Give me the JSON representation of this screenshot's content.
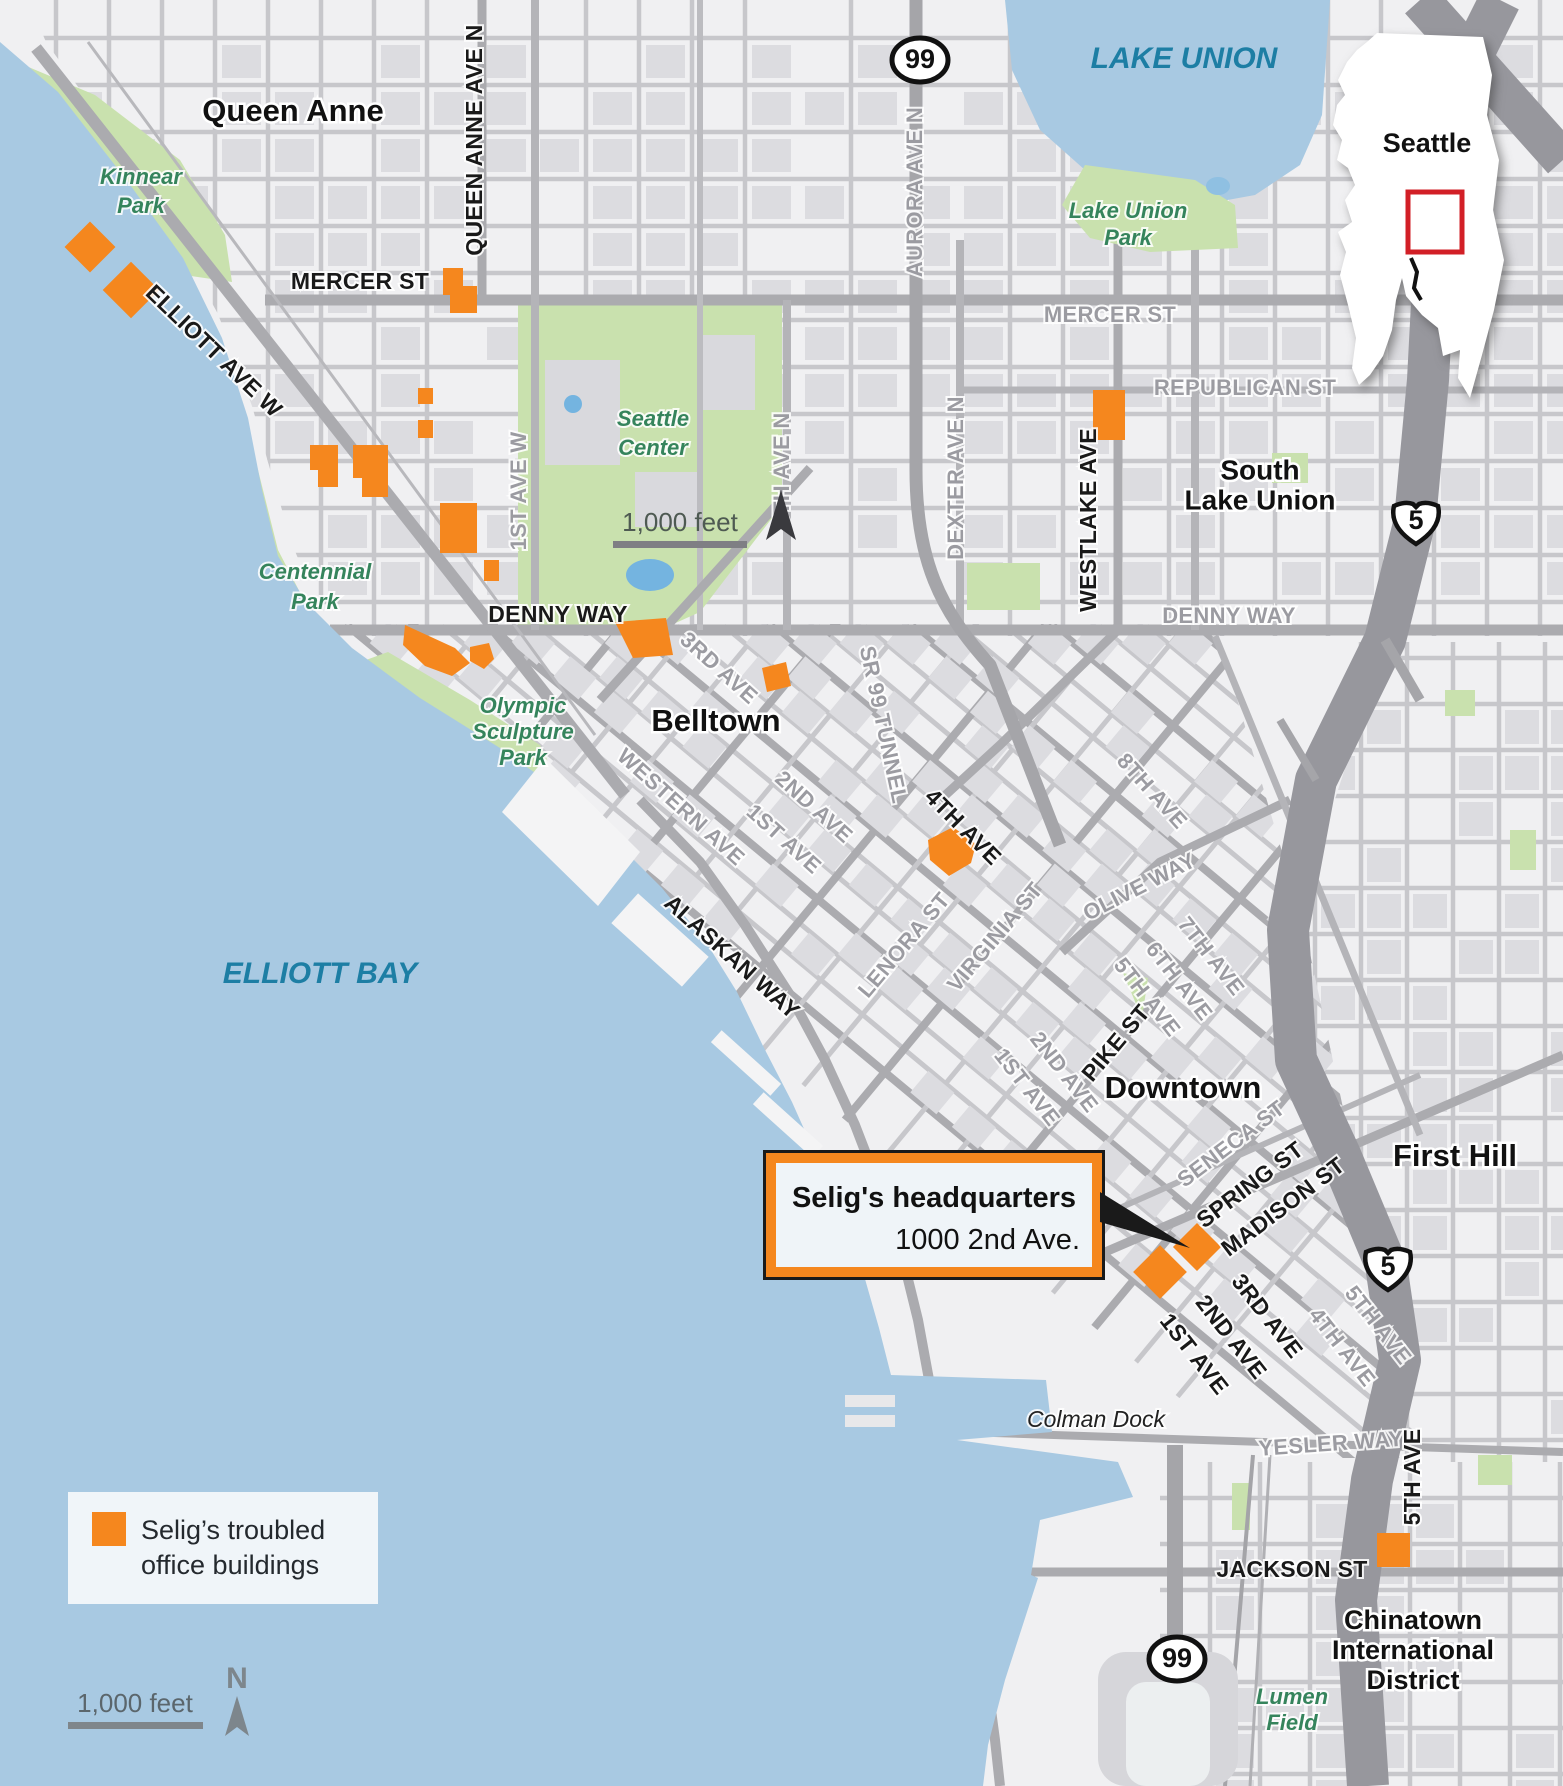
{
  "colors": {
    "marker": "#f5871e",
    "water": "#a8c9e2",
    "park": "#c9e1ae",
    "land": "#f0f0f2",
    "block": "#dcdce0",
    "street": "#c7c7cb",
    "major_road": "#ababaf",
    "freeway": "#97979d",
    "inset_rect": "#d21f26",
    "water_label": "#1d7ea4",
    "park_label": "#35845c"
  },
  "legend": {
    "line1": "Selig’s troubled",
    "line2": "office buildings"
  },
  "callout": {
    "title": "Selig's headquarters",
    "subtitle": "1000 2nd Ave."
  },
  "inset": {
    "city": "Seattle"
  },
  "scale_top": {
    "label": "1,000 feet"
  },
  "scale_bottom": {
    "label": "1,000 feet",
    "north": "N"
  },
  "map": {
    "labels": [
      {
        "id": "queen-anne",
        "t": "Queen Anne",
        "x": 293,
        "y": 113,
        "r": 0,
        "c": "nb"
      },
      {
        "id": "belltown",
        "t": "Belltown",
        "x": 716,
        "y": 723,
        "r": 0,
        "c": "nb"
      },
      {
        "id": "downtown",
        "t": "Downtown",
        "x": 1183,
        "y": 1090,
        "r": 0,
        "c": "nb"
      },
      {
        "id": "first-hill",
        "t": "First Hill",
        "x": 1455,
        "y": 1158,
        "r": 0,
        "c": "nb"
      },
      {
        "id": "slu-1",
        "t": "South",
        "x": 1260,
        "y": 472,
        "r": 0,
        "c": "nb2"
      },
      {
        "id": "slu-2",
        "t": "Lake Union",
        "x": 1260,
        "y": 502,
        "r": 0,
        "c": "nb2"
      },
      {
        "id": "cid-1",
        "t": "Chinatown",
        "x": 1413,
        "y": 1622,
        "r": 0,
        "c": "nb3"
      },
      {
        "id": "cid-2",
        "t": "International",
        "x": 1413,
        "y": 1652,
        "r": 0,
        "c": "nb3"
      },
      {
        "id": "cid-3",
        "t": "District",
        "x": 1413,
        "y": 1682,
        "r": 0,
        "c": "nb3"
      },
      {
        "id": "lake-union",
        "t": "LAKE UNION",
        "x": 1184,
        "y": 60,
        "r": 0,
        "c": "wa"
      },
      {
        "id": "elliott-bay",
        "t": "ELLIOTT BAY",
        "x": 320,
        "y": 975,
        "r": 0,
        "c": "wa"
      },
      {
        "id": "kinnear-1",
        "t": "Kinnear",
        "x": 141,
        "y": 178,
        "r": 0,
        "c": "pk"
      },
      {
        "id": "kinnear-2",
        "t": "Park",
        "x": 141,
        "y": 207,
        "r": 0,
        "c": "pk"
      },
      {
        "id": "lup-1",
        "t": "Lake Union",
        "x": 1128,
        "y": 212,
        "r": 0,
        "c": "pk"
      },
      {
        "id": "lup-2",
        "t": "Park",
        "x": 1128,
        "y": 239,
        "r": 0,
        "c": "pk"
      },
      {
        "id": "sc-1",
        "t": "Seattle",
        "x": 653,
        "y": 420,
        "r": 0,
        "c": "pk"
      },
      {
        "id": "sc-2",
        "t": "Center",
        "x": 653,
        "y": 449,
        "r": 0,
        "c": "pk"
      },
      {
        "id": "cen-1",
        "t": "Centennial",
        "x": 315,
        "y": 573,
        "r": 0,
        "c": "pk"
      },
      {
        "id": "cen-2",
        "t": "Park",
        "x": 315,
        "y": 603,
        "r": 0,
        "c": "pk"
      },
      {
        "id": "osp-1",
        "t": "Olympic",
        "x": 523,
        "y": 707,
        "r": 0,
        "c": "pk"
      },
      {
        "id": "osp-2",
        "t": "Sculpture",
        "x": 523,
        "y": 733,
        "r": 0,
        "c": "pk"
      },
      {
        "id": "osp-3",
        "t": "Park",
        "x": 523,
        "y": 759,
        "r": 0,
        "c": "pk"
      },
      {
        "id": "lumen-1",
        "t": "Lumen",
        "x": 1292,
        "y": 1698,
        "r": 0,
        "c": "pk"
      },
      {
        "id": "lumen-2",
        "t": "Field",
        "x": 1292,
        "y": 1724,
        "r": 0,
        "c": "pk"
      },
      {
        "id": "colman-dock",
        "t": "Colman Dock",
        "x": 1096,
        "y": 1421,
        "r": 0,
        "c": "pl"
      },
      {
        "id": "mercer-w",
        "t": "MERCER ST",
        "x": 360,
        "y": 283,
        "r": 0,
        "c": "sd"
      },
      {
        "id": "mercer-e",
        "t": "MERCER ST",
        "x": 1110,
        "y": 316,
        "r": 0,
        "c": "sg"
      },
      {
        "id": "republican",
        "t": "REPUBLICAN ST",
        "x": 1245,
        "y": 389,
        "r": 0,
        "c": "sg"
      },
      {
        "id": "denny-w",
        "t": "DENNY WAY",
        "x": 558,
        "y": 616,
        "r": 0,
        "c": "sd"
      },
      {
        "id": "denny-e",
        "t": "DENNY WAY",
        "x": 1229,
        "y": 617,
        "r": 0,
        "c": "sg"
      },
      {
        "id": "queen-anne-ave",
        "t": "QUEEN ANNE AVE N",
        "x": 476,
        "y": 140,
        "r": -90,
        "c": "sd"
      },
      {
        "id": "aurora",
        "t": "AURORA AVE N",
        "x": 916,
        "y": 192,
        "r": -90,
        "c": "sg"
      },
      {
        "id": "first-ave-w",
        "t": "1ST AVE W",
        "x": 520,
        "y": 491,
        "r": -90,
        "c": "sg"
      },
      {
        "id": "fifth-ave-n",
        "t": "5TH AVE N",
        "x": 783,
        "y": 470,
        "r": -90,
        "c": "sg"
      },
      {
        "id": "dexter",
        "t": "DEXTER AVE N",
        "x": 957,
        "y": 478,
        "r": -90,
        "c": "sg"
      },
      {
        "id": "westlake",
        "t": "WESTLAKE AVE",
        "x": 1090,
        "y": 520,
        "r": -90,
        "c": "sd"
      },
      {
        "id": "elliott-ave",
        "t": "ELLIOTT AVE W",
        "x": 213,
        "y": 352,
        "r": 44,
        "c": "sd"
      },
      {
        "id": "alaskan",
        "t": "ALASKAN WAY",
        "x": 731,
        "y": 958,
        "r": 42,
        "c": "sd"
      },
      {
        "id": "third-bt",
        "t": "3RD AVE",
        "x": 718,
        "y": 669,
        "r": 42,
        "c": "sg"
      },
      {
        "id": "western",
        "t": "WESTERN AVE",
        "x": 680,
        "y": 808,
        "r": 42,
        "c": "sg"
      },
      {
        "id": "second-bt",
        "t": "2ND AVE",
        "x": 813,
        "y": 808,
        "r": 42,
        "c": "sg"
      },
      {
        "id": "first-bt",
        "t": "1ST AVE",
        "x": 783,
        "y": 840,
        "r": 42,
        "c": "sg"
      },
      {
        "id": "sr99",
        "t": "SR 99 TUNNEL",
        "x": 882,
        "y": 725,
        "r": 78,
        "c": "sg"
      },
      {
        "id": "fourth-ave",
        "t": "4TH AVE",
        "x": 962,
        "y": 828,
        "r": 45,
        "c": "sd"
      },
      {
        "id": "lenora",
        "t": "LENORA ST",
        "x": 905,
        "y": 946,
        "r": -50,
        "c": "sg"
      },
      {
        "id": "virginia",
        "t": "VIRGINIA ST",
        "x": 996,
        "y": 938,
        "r": -50,
        "c": "sg"
      },
      {
        "id": "olive",
        "t": "OLIVE WAY",
        "x": 1140,
        "y": 888,
        "r": -27,
        "c": "sg"
      },
      {
        "id": "eighth",
        "t": "8TH AVE",
        "x": 1151,
        "y": 792,
        "r": 48,
        "c": "sg"
      },
      {
        "id": "seventh",
        "t": "7TH AVE",
        "x": 1210,
        "y": 957,
        "r": 52,
        "c": "sg"
      },
      {
        "id": "sixth",
        "t": "6TH AVE",
        "x": 1178,
        "y": 982,
        "r": 52,
        "c": "sg"
      },
      {
        "id": "fifth-dt",
        "t": "5TH AVE",
        "x": 1146,
        "y": 998,
        "r": 52,
        "c": "sg"
      },
      {
        "id": "pike",
        "t": "PIKE ST",
        "x": 1117,
        "y": 1044,
        "r": -50,
        "c": "sd"
      },
      {
        "id": "first-pk",
        "t": "1ST AVE",
        "x": 1026,
        "y": 1088,
        "r": 52,
        "c": "sg"
      },
      {
        "id": "second-pk",
        "t": "2ND AVE",
        "x": 1063,
        "y": 1073,
        "r": 52,
        "c": "sg"
      },
      {
        "id": "seneca",
        "t": "SENECA ST",
        "x": 1232,
        "y": 1145,
        "r": -37,
        "c": "sg"
      },
      {
        "id": "spring",
        "t": "SPRING ST",
        "x": 1251,
        "y": 1186,
        "r": -37,
        "c": "sd"
      },
      {
        "id": "madison",
        "t": "MADISON ST",
        "x": 1284,
        "y": 1208,
        "r": -37,
        "c": "sd"
      },
      {
        "id": "first-dt",
        "t": "1ST AVE",
        "x": 1193,
        "y": 1355,
        "r": 52,
        "c": "sd"
      },
      {
        "id": "second-dt",
        "t": "2ND AVE",
        "x": 1230,
        "y": 1338,
        "r": 52,
        "c": "sd"
      },
      {
        "id": "third-dt",
        "t": "3RD AVE",
        "x": 1266,
        "y": 1317,
        "r": 52,
        "c": "sd"
      },
      {
        "id": "fourth-dt",
        "t": "4TH AVE",
        "x": 1341,
        "y": 1348,
        "r": 52,
        "c": "sg"
      },
      {
        "id": "fifth-dt2",
        "t": "5TH AVE",
        "x": 1377,
        "y": 1326,
        "r": 52,
        "c": "sg"
      },
      {
        "id": "yesler",
        "t": "YESLER WAY",
        "x": 1331,
        "y": 1445,
        "r": -4,
        "c": "sg"
      },
      {
        "id": "jackson",
        "t": "JACKSON ST",
        "x": 1292,
        "y": 1571,
        "r": 0,
        "c": "sd"
      },
      {
        "id": "fifth-s",
        "t": "5TH AVE",
        "x": 1414,
        "y": 1477,
        "r": -90,
        "c": "sd"
      }
    ],
    "shields": [
      {
        "kind": "us",
        "label": "99",
        "x": 920,
        "y": 60
      },
      {
        "kind": "us",
        "label": "99",
        "x": 1177,
        "y": 1659
      },
      {
        "kind": "interstate",
        "label": "5",
        "x": 1416,
        "y": 519
      },
      {
        "kind": "interstate",
        "label": "5",
        "x": 1388,
        "y": 1265
      }
    ],
    "buildings": [
      {
        "k": "d",
        "x": 90,
        "y": 247,
        "s": 36
      },
      {
        "k": "d",
        "x": 131,
        "y": 290,
        "s": 40
      },
      {
        "k": "p",
        "pts": [
          [
            443,
            268
          ],
          [
            463,
            268
          ],
          [
            463,
            286
          ],
          [
            477,
            286
          ],
          [
            477,
            313
          ],
          [
            450,
            313
          ],
          [
            450,
            295
          ],
          [
            443,
            295
          ]
        ]
      },
      {
        "k": "r",
        "x": 418,
        "y": 388,
        "w": 15,
        "h": 16
      },
      {
        "k": "r",
        "x": 418,
        "y": 420,
        "w": 15,
        "h": 18
      },
      {
        "k": "p",
        "pts": [
          [
            310,
            445
          ],
          [
            338,
            445
          ],
          [
            338,
            487
          ],
          [
            318,
            487
          ],
          [
            318,
            470
          ],
          [
            310,
            470
          ]
        ]
      },
      {
        "k": "p",
        "pts": [
          [
            353,
            445
          ],
          [
            388,
            445
          ],
          [
            388,
            497
          ],
          [
            362,
            497
          ],
          [
            362,
            478
          ],
          [
            353,
            478
          ]
        ]
      },
      {
        "k": "r",
        "x": 440,
        "y": 503,
        "w": 37,
        "h": 50
      },
      {
        "k": "r",
        "x": 484,
        "y": 560,
        "w": 15,
        "h": 21
      },
      {
        "k": "p",
        "pts": [
          [
            405,
            625
          ],
          [
            455,
            648
          ],
          [
            470,
            663
          ],
          [
            452,
            676
          ],
          [
            425,
            666
          ],
          [
            403,
            645
          ]
        ]
      },
      {
        "k": "p",
        "pts": [
          [
            470,
            647
          ],
          [
            489,
            643
          ],
          [
            494,
            659
          ],
          [
            484,
            669
          ],
          [
            470,
            661
          ]
        ]
      },
      {
        "k": "p",
        "pts": [
          [
            615,
            622
          ],
          [
            666,
            618
          ],
          [
            673,
            655
          ],
          [
            633,
            658
          ]
        ]
      },
      {
        "k": "p",
        "pts": [
          [
            762,
            668
          ],
          [
            786,
            662
          ],
          [
            791,
            686
          ],
          [
            767,
            692
          ]
        ]
      },
      {
        "k": "p",
        "pts": [
          [
            928,
            840
          ],
          [
            953,
            827
          ],
          [
            976,
            844
          ],
          [
            971,
            863
          ],
          [
            949,
            876
          ],
          [
            930,
            860
          ]
        ]
      },
      {
        "k": "r",
        "x": 1093,
        "y": 390,
        "w": 32,
        "h": 50
      },
      {
        "k": "d",
        "x": 1197,
        "y": 1247,
        "s": 34
      },
      {
        "k": "d",
        "x": 1160,
        "y": 1272,
        "s": 38
      },
      {
        "k": "r",
        "x": 1377,
        "y": 1533,
        "w": 33,
        "h": 34
      }
    ]
  }
}
